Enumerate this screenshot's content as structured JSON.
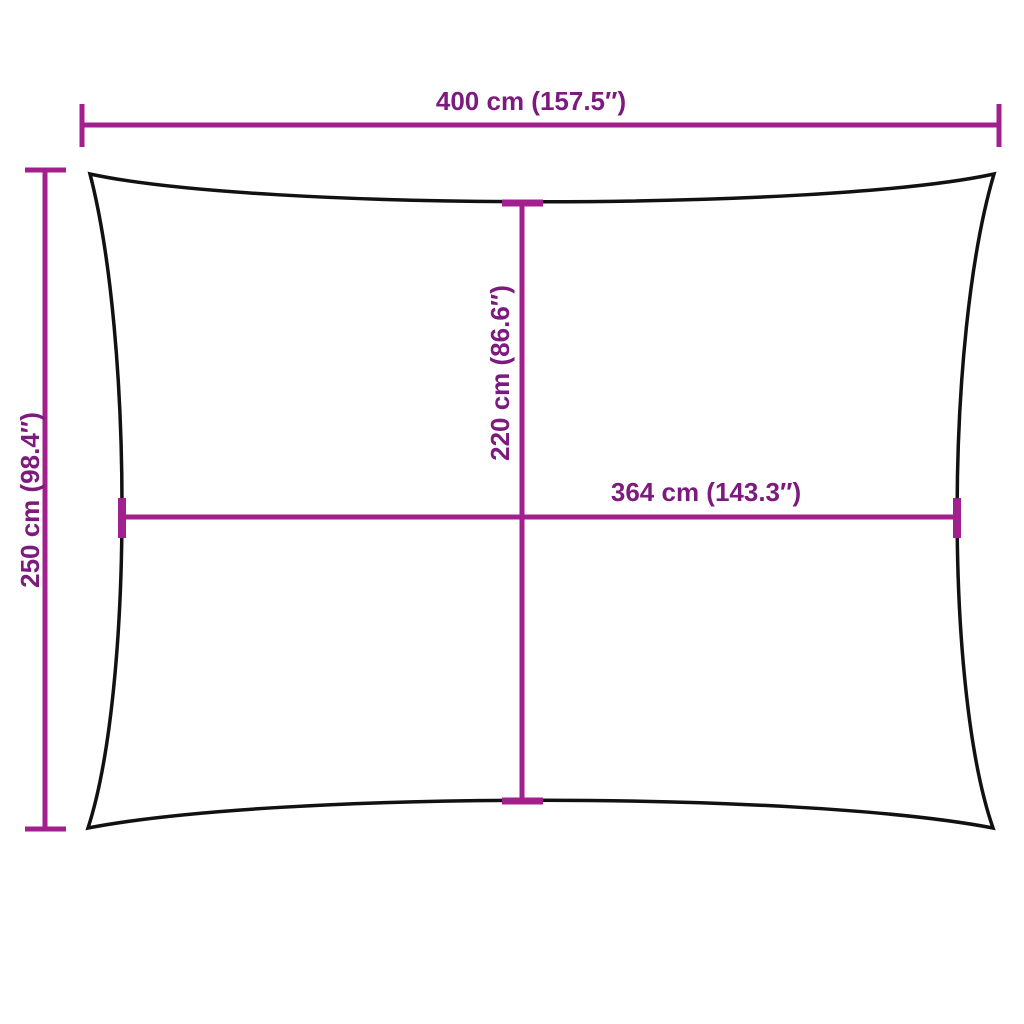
{
  "diagram": {
    "type": "product-dimension-diagram",
    "subject": "rectangular shade sail outline with concave edges",
    "labels": {
      "width_top": "400 cm (157.5″)",
      "height_left": "250 cm (98.4″)",
      "height_center": "220 cm (86.6″)",
      "width_center": "364 cm (143.3″)"
    },
    "colors": {
      "dimension_line": "#A1208E",
      "dimension_text": "#7C1A7D",
      "outline": "#111111",
      "background": "#FFFFFF"
    }
  }
}
